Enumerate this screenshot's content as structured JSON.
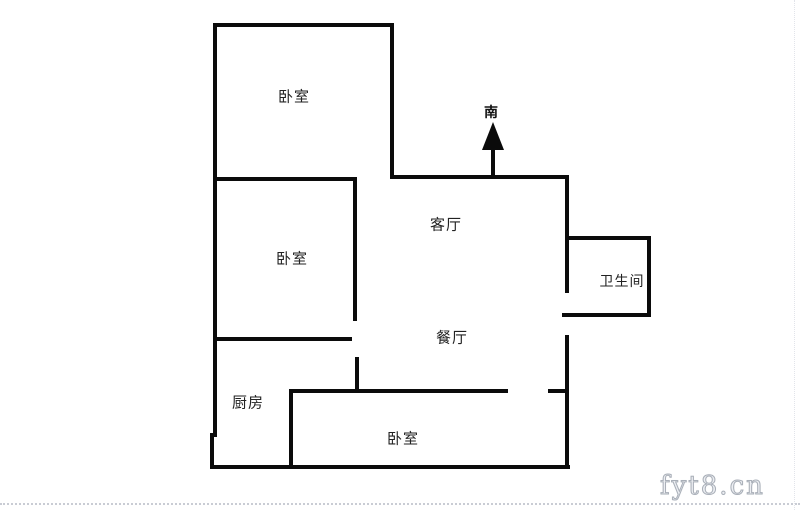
{
  "page": {
    "background": "#ffffff",
    "wall_color": "#0b0b0b",
    "label_color": "#222222",
    "watermark_color": "#aab0b9"
  },
  "compass": {
    "label": "南"
  },
  "rooms": [
    {
      "id": "bedroom-top",
      "label": "卧室"
    },
    {
      "id": "bedroom-left",
      "label": "卧室"
    },
    {
      "id": "living-room",
      "label": "客厅"
    },
    {
      "id": "dining-room",
      "label": "餐厅"
    },
    {
      "id": "bathroom",
      "label": "卫生间"
    },
    {
      "id": "kitchen",
      "label": "厨房"
    },
    {
      "id": "bedroom-bottom",
      "label": "卧室"
    }
  ],
  "watermark": {
    "text": "fyt8.cn"
  }
}
